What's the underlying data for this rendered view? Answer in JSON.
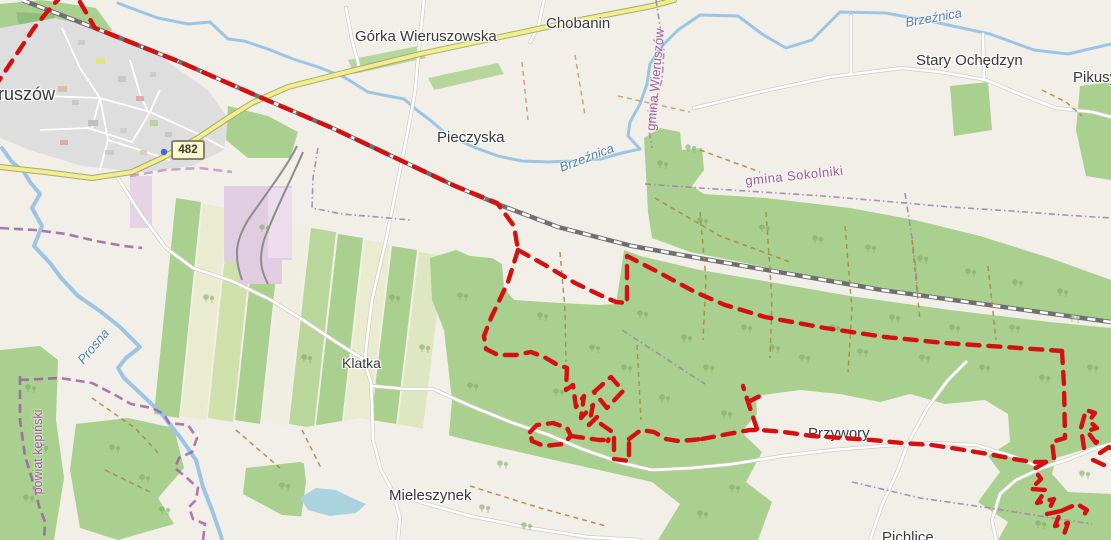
{
  "map": {
    "description": "OpenStreetMap extract with red dashed GPS route around Wieruszów forest area",
    "road_shield": {
      "text": "482"
    },
    "place_labels": [
      {
        "id": "wieruszow",
        "text": "Wieruszów"
      },
      {
        "id": "gorka-wieruszowska",
        "text": "Górka Wieruszowska"
      },
      {
        "id": "chobanin",
        "text": "Chobanin"
      },
      {
        "id": "pieczyska",
        "text": "Pieczyska"
      },
      {
        "id": "stary-ochedzyn",
        "text": "Stary Ochędzyn"
      },
      {
        "id": "pikusy",
        "text": "Pikusy"
      },
      {
        "id": "klatka",
        "text": "Klatka"
      },
      {
        "id": "mieleszynek",
        "text": "Mieleszynek"
      },
      {
        "id": "przywory",
        "text": "Przywory"
      },
      {
        "id": "pichlice",
        "text": "Pichlice"
      }
    ],
    "admin_labels": [
      {
        "id": "gmina-wieruszow",
        "text": "gmina Wieruszów"
      },
      {
        "id": "gmina-sokolniki",
        "text": "gmina Sokolniki"
      },
      {
        "id": "powiat-kepinski",
        "text": "powiat kępiński"
      }
    ],
    "water_labels": [
      {
        "id": "brzeznica-upper",
        "text": "Brzeźnica"
      },
      {
        "id": "brzeznica-lower",
        "text": "Brzeźnica"
      },
      {
        "id": "prosna",
        "text": "Prosna"
      }
    ],
    "colors": {
      "route": "#d41010",
      "forest": "#a9d08e",
      "water": "#9cc5e5",
      "powiat_boundary": "#9b59a2",
      "background": "#f2efe9"
    }
  }
}
